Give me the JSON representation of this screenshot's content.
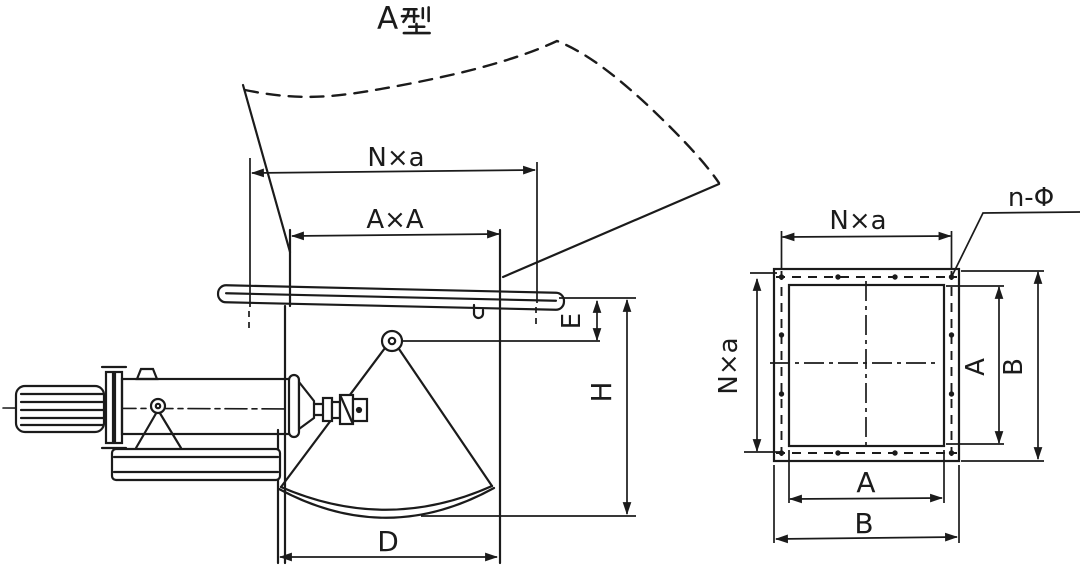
{
  "title": {
    "text": "A型",
    "latin_part": "A"
  },
  "colors": {
    "ink": "#1b1b1b",
    "background": "#ffffff"
  },
  "left_view": {
    "dim_bolt_pitch_top": "N×a",
    "dim_opening_top": "A×A",
    "dim_flange_to_pivot": "E",
    "dim_overall_height": "H",
    "dim_gate_width": "D"
  },
  "right_view": {
    "dim_bolt_pitch_top": "N×a",
    "dim_bolt_pitch_left": "N×a",
    "callout_bolt_holes": "n-Φ",
    "dim_opening_width_bottom": "A",
    "dim_overall_width_bottom": "B",
    "dim_opening_height_right": "A",
    "dim_overall_height_right": "B"
  }
}
